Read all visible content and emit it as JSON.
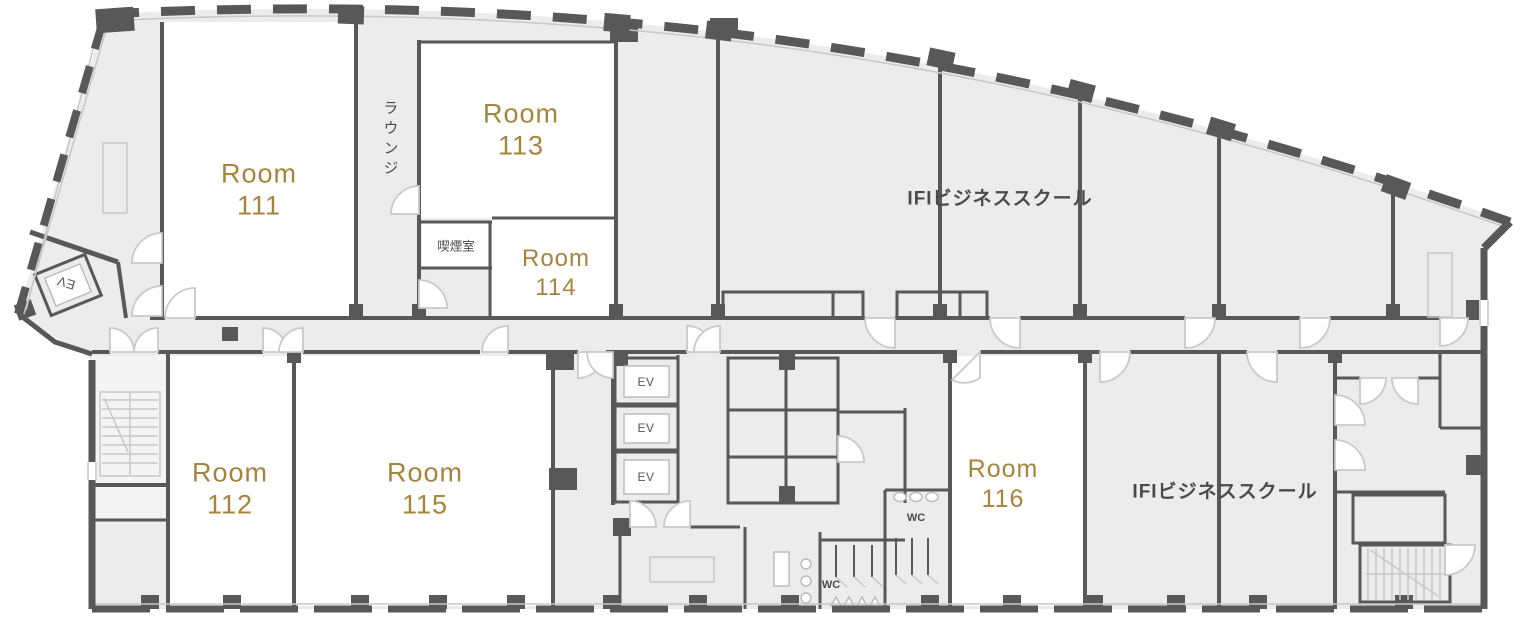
{
  "floorplan": {
    "rooms": [
      {
        "name": "Room",
        "number": "111"
      },
      {
        "name": "Room",
        "number": "112"
      },
      {
        "name": "Room",
        "number": "113"
      },
      {
        "name": "Room",
        "number": "114"
      },
      {
        "name": "Room",
        "number": "115"
      },
      {
        "name": "Room",
        "number": "116"
      }
    ],
    "areas": {
      "lounge": "ラウンジ",
      "smoking_room": "喫煙室",
      "business_school_upper": "IFIビジネススクール",
      "business_school_lower": "IFIビジネススクール"
    },
    "labels": {
      "elevator": "EV",
      "toilet": "WC"
    },
    "colors": {
      "wall": "#585858",
      "floor": "#ececec",
      "room_fill": "#ffffff",
      "room_label": "#a5853e",
      "text": "#4a4a4a"
    }
  }
}
